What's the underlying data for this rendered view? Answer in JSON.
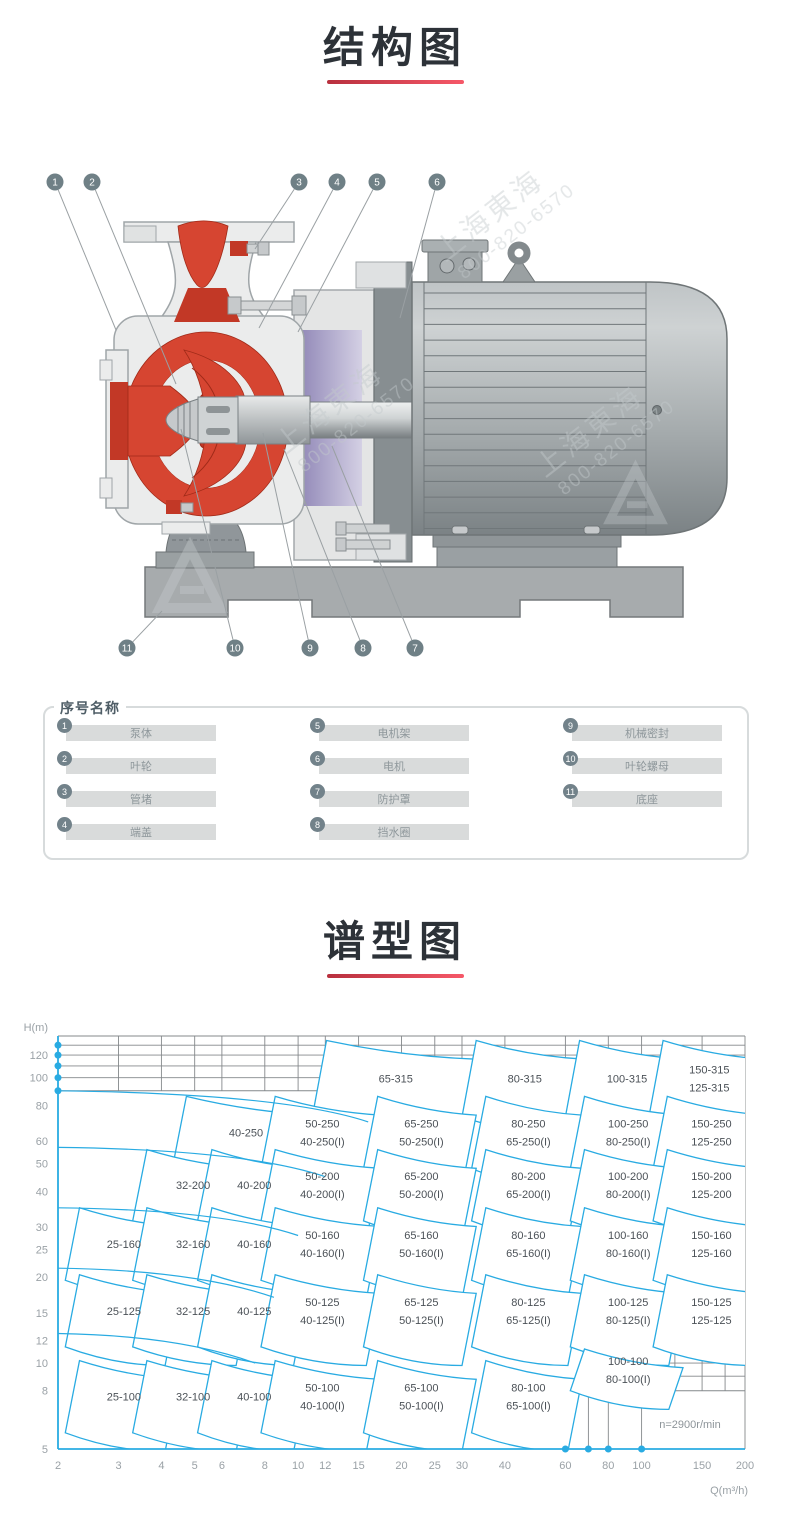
{
  "sections": [
    {
      "title": "结构图"
    },
    {
      "title": "谱型图"
    }
  ],
  "legend": {
    "title": "序号名称",
    "items": [
      {
        "n": "1",
        "label": "泵体"
      },
      {
        "n": "2",
        "label": "叶轮"
      },
      {
        "n": "3",
        "label": "管堵"
      },
      {
        "n": "4",
        "label": "端盖"
      },
      {
        "n": "5",
        "label": "电机架"
      },
      {
        "n": "6",
        "label": "电机"
      },
      {
        "n": "7",
        "label": "防护罩"
      },
      {
        "n": "8",
        "label": "挡水圈"
      },
      {
        "n": "9",
        "label": "机械密封"
      },
      {
        "n": "10",
        "label": "叶轮螺母"
      },
      {
        "n": "11",
        "label": "底座"
      }
    ]
  },
  "diagram": {
    "watermark": {
      "brand": "上海東海",
      "phone": "800-820-6570"
    },
    "callouts": [
      {
        "n": "1",
        "cx": 55,
        "cy": 182,
        "tx": 116,
        "ty": 330
      },
      {
        "n": "2",
        "cx": 92,
        "cy": 182,
        "tx": 176,
        "ty": 384
      },
      {
        "n": "3",
        "cx": 299,
        "cy": 182,
        "tx": 255,
        "ty": 249
      },
      {
        "n": "4",
        "cx": 337,
        "cy": 182,
        "tx": 259,
        "ty": 328
      },
      {
        "n": "5",
        "cx": 377,
        "cy": 182,
        "tx": 298,
        "ty": 332
      },
      {
        "n": "6",
        "cx": 437,
        "cy": 182,
        "tx": 400,
        "ty": 318
      },
      {
        "n": "7",
        "cx": 415,
        "cy": 648,
        "tx": 332,
        "ty": 446
      },
      {
        "n": "8",
        "cx": 363,
        "cy": 648,
        "tx": 284,
        "ty": 449
      },
      {
        "n": "9",
        "cx": 310,
        "cy": 648,
        "tx": 263,
        "ty": 433
      },
      {
        "n": "10",
        "cx": 235,
        "cy": 648,
        "tx": 181,
        "ty": 429
      },
      {
        "n": "11",
        "cx": 127,
        "cy": 648,
        "tx": 162,
        "ty": 611
      }
    ]
  },
  "chart_data": {
    "type": "area",
    "kind": "pump-selection-chart",
    "title": "谱型图",
    "xlabel": "Q(m³/h)",
    "ylabel": "H(m)",
    "x_log": true,
    "y_log": true,
    "x_range": [
      2,
      200
    ],
    "y_range": [
      5,
      140
    ],
    "x_ticks": [
      2,
      3,
      4,
      5,
      6,
      8,
      10,
      12,
      15,
      20,
      25,
      30,
      40,
      60,
      80,
      100,
      150,
      200
    ],
    "y_ticks": [
      120,
      100,
      80,
      60,
      50,
      40,
      30,
      25,
      20,
      15,
      12,
      10,
      8,
      5
    ],
    "annotation": "n=2900r/min",
    "legend_position": "none",
    "grid": true,
    "colors": {
      "region": "#29abe2",
      "grid": "#84888b",
      "axis": "#29abe2",
      "label": "#4b5157",
      "tick": "#9aa1a6"
    },
    "top_grid": {
      "h_lines": [
        140,
        130,
        120,
        110,
        100,
        90
      ],
      "v_lines": [
        3,
        4,
        5,
        6,
        8,
        10,
        12,
        15,
        20,
        25,
        30,
        40,
        60,
        80,
        100,
        150
      ],
      "band": [
        90,
        140
      ]
    },
    "bottom_grid": {
      "h_lines": [
        {
          "h": 12.2,
          "q": [
            108,
            200
          ]
        },
        {
          "h": 11,
          "q": [
            108,
            200
          ]
        },
        {
          "h": 10,
          "q": [
            108,
            200
          ]
        },
        {
          "h": 9,
          "q": [
            108,
            200
          ]
        },
        {
          "h": 8,
          "q": [
            55,
            200
          ]
        }
      ],
      "v_lines": [
        {
          "q": 110,
          "h": [
            8,
            12.2
          ]
        },
        {
          "q": 125,
          "h": [
            8,
            12.2
          ]
        },
        {
          "q": 150,
          "h": [
            8,
            12.2
          ]
        },
        {
          "q": 175,
          "h": [
            8,
            12.2
          ]
        },
        {
          "q": 60,
          "h": [
            5,
            8
          ]
        },
        {
          "q": 70,
          "h": [
            5,
            8
          ]
        },
        {
          "q": 80,
          "h": [
            5,
            8
          ]
        },
        {
          "q": 100,
          "h": [
            5,
            8
          ]
        }
      ]
    },
    "axis_dots": {
      "y": [
        130,
        120,
        110,
        100,
        90
      ],
      "x": [
        60,
        70,
        80,
        100
      ]
    },
    "family_curves": [
      [
        2,
        90,
        9,
        88,
        16,
        70
      ],
      [
        2,
        57,
        7,
        56,
        12,
        45
      ],
      [
        2,
        35,
        6,
        34.5,
        10,
        28
      ],
      [
        2,
        21.5,
        5,
        21.2,
        8.5,
        17
      ],
      [
        2,
        12.7,
        4.5,
        12.5,
        7.5,
        10
      ]
    ],
    "columns": {
      "25": [
        2.1,
        4.1
      ],
      "32": [
        3.3,
        6.6
      ],
      "40": [
        5.1,
        9.7
      ],
      "50": [
        7.8,
        15.8
      ],
      "65": [
        15.5,
        30
      ],
      "80": [
        32,
        61
      ],
      "100": [
        62,
        120
      ],
      "150": [
        108,
        210
      ]
    },
    "rows": {
      "100": [
        5.7,
        10.2
      ],
      "125": [
        11.4,
        20.4
      ],
      "160": [
        19.5,
        35
      ],
      "200": [
        31.5,
        56
      ],
      "250": [
        48,
        86
      ],
      "315": [
        73,
        135
      ]
    },
    "shape": {
      "lean": 1.1,
      "droop": 0.86,
      "top_ctrl": 0.88,
      "bottom_ctrl": 0.86
    },
    "regions": [
      {
        "labels": [
          "65-315"
        ],
        "row": "315",
        "q": [
          11,
          30
        ]
      },
      {
        "labels": [
          "80-315"
        ],
        "row": "315",
        "q": [
          30,
          62
        ]
      },
      {
        "labels": [
          "100-315"
        ],
        "row": "315",
        "q": [
          60,
          122
        ]
      },
      {
        "labels": [
          "150-315",
          "125-315"
        ],
        "row": "315",
        "q": [
          105,
          210
        ]
      },
      {
        "labels": [
          "40-250"
        ],
        "row": "250",
        "q": [
          4.3,
          10.3
        ]
      },
      {
        "labels": [
          "50-250",
          "40-250(I)"
        ],
        "row": "250",
        "col": "50"
      },
      {
        "labels": [
          "65-250",
          "50-250(I)"
        ],
        "row": "250",
        "col": "65"
      },
      {
        "labels": [
          "80-250",
          "65-250(I)"
        ],
        "row": "250",
        "col": "80"
      },
      {
        "labels": [
          "100-250",
          "80-250(I)"
        ],
        "row": "250",
        "col": "100"
      },
      {
        "labels": [
          "150-250",
          "125-250"
        ],
        "row": "250",
        "col": "150"
      },
      {
        "labels": [
          "32-200"
        ],
        "row": "200",
        "col": "32"
      },
      {
        "labels": [
          "40-200"
        ],
        "row": "200",
        "col": "40"
      },
      {
        "labels": [
          "50-200",
          "40-200(I)"
        ],
        "row": "200",
        "col": "50"
      },
      {
        "labels": [
          "65-200",
          "50-200(I)"
        ],
        "row": "200",
        "col": "65"
      },
      {
        "labels": [
          "80-200",
          "65-200(I)"
        ],
        "row": "200",
        "col": "80"
      },
      {
        "labels": [
          "100-200",
          "80-200(I)"
        ],
        "row": "200",
        "col": "100"
      },
      {
        "labels": [
          "150-200",
          "125-200"
        ],
        "row": "200",
        "col": "150"
      },
      {
        "labels": [
          "25-160"
        ],
        "row": "160",
        "col": "25"
      },
      {
        "labels": [
          "32-160"
        ],
        "row": "160",
        "col": "32"
      },
      {
        "labels": [
          "40-160"
        ],
        "row": "160",
        "col": "40"
      },
      {
        "labels": [
          "50-160",
          "40-160(I)"
        ],
        "row": "160",
        "col": "50"
      },
      {
        "labels": [
          "65-160",
          "50-160(I)"
        ],
        "row": "160",
        "col": "65"
      },
      {
        "labels": [
          "80-160",
          "65-160(I)"
        ],
        "row": "160",
        "col": "80"
      },
      {
        "labels": [
          "100-160",
          "80-160(I)"
        ],
        "row": "160",
        "col": "100"
      },
      {
        "labels": [
          "150-160",
          "125-160"
        ],
        "row": "160",
        "col": "150"
      },
      {
        "labels": [
          "25-125"
        ],
        "row": "125",
        "col": "25"
      },
      {
        "labels": [
          "32-125"
        ],
        "row": "125",
        "col": "32"
      },
      {
        "labels": [
          "40-125"
        ],
        "row": "125",
        "col": "40"
      },
      {
        "labels": [
          "50-125",
          "40-125(I)"
        ],
        "row": "125",
        "col": "50"
      },
      {
        "labels": [
          "65-125",
          "50-125(I)"
        ],
        "row": "125",
        "col": "65"
      },
      {
        "labels": [
          "80-125",
          "65-125(I)"
        ],
        "row": "125",
        "col": "80"
      },
      {
        "labels": [
          "100-125",
          "80-125(I)"
        ],
        "row": "125",
        "col": "100"
      },
      {
        "labels": [
          "150-125",
          "125-125"
        ],
        "row": "125",
        "col": "150"
      },
      {
        "labels": [
          "25-100"
        ],
        "row": "100",
        "col": "25"
      },
      {
        "labels": [
          "32-100"
        ],
        "row": "100",
        "col": "32"
      },
      {
        "labels": [
          "40-100"
        ],
        "row": "100",
        "col": "40"
      },
      {
        "labels": [
          "50-100",
          "40-100(I)"
        ],
        "row": "100",
        "col": "50"
      },
      {
        "labels": [
          "65-100",
          "50-100(I)"
        ],
        "row": "100",
        "col": "65"
      },
      {
        "labels": [
          "80-100",
          "65-100(I)"
        ],
        "row": "100",
        "col": "80"
      },
      {
        "labels": [
          "100-100",
          "80-100(I)"
        ],
        "row": "100",
        "col": "100",
        "h": [
          8,
          11.2
        ]
      }
    ]
  }
}
